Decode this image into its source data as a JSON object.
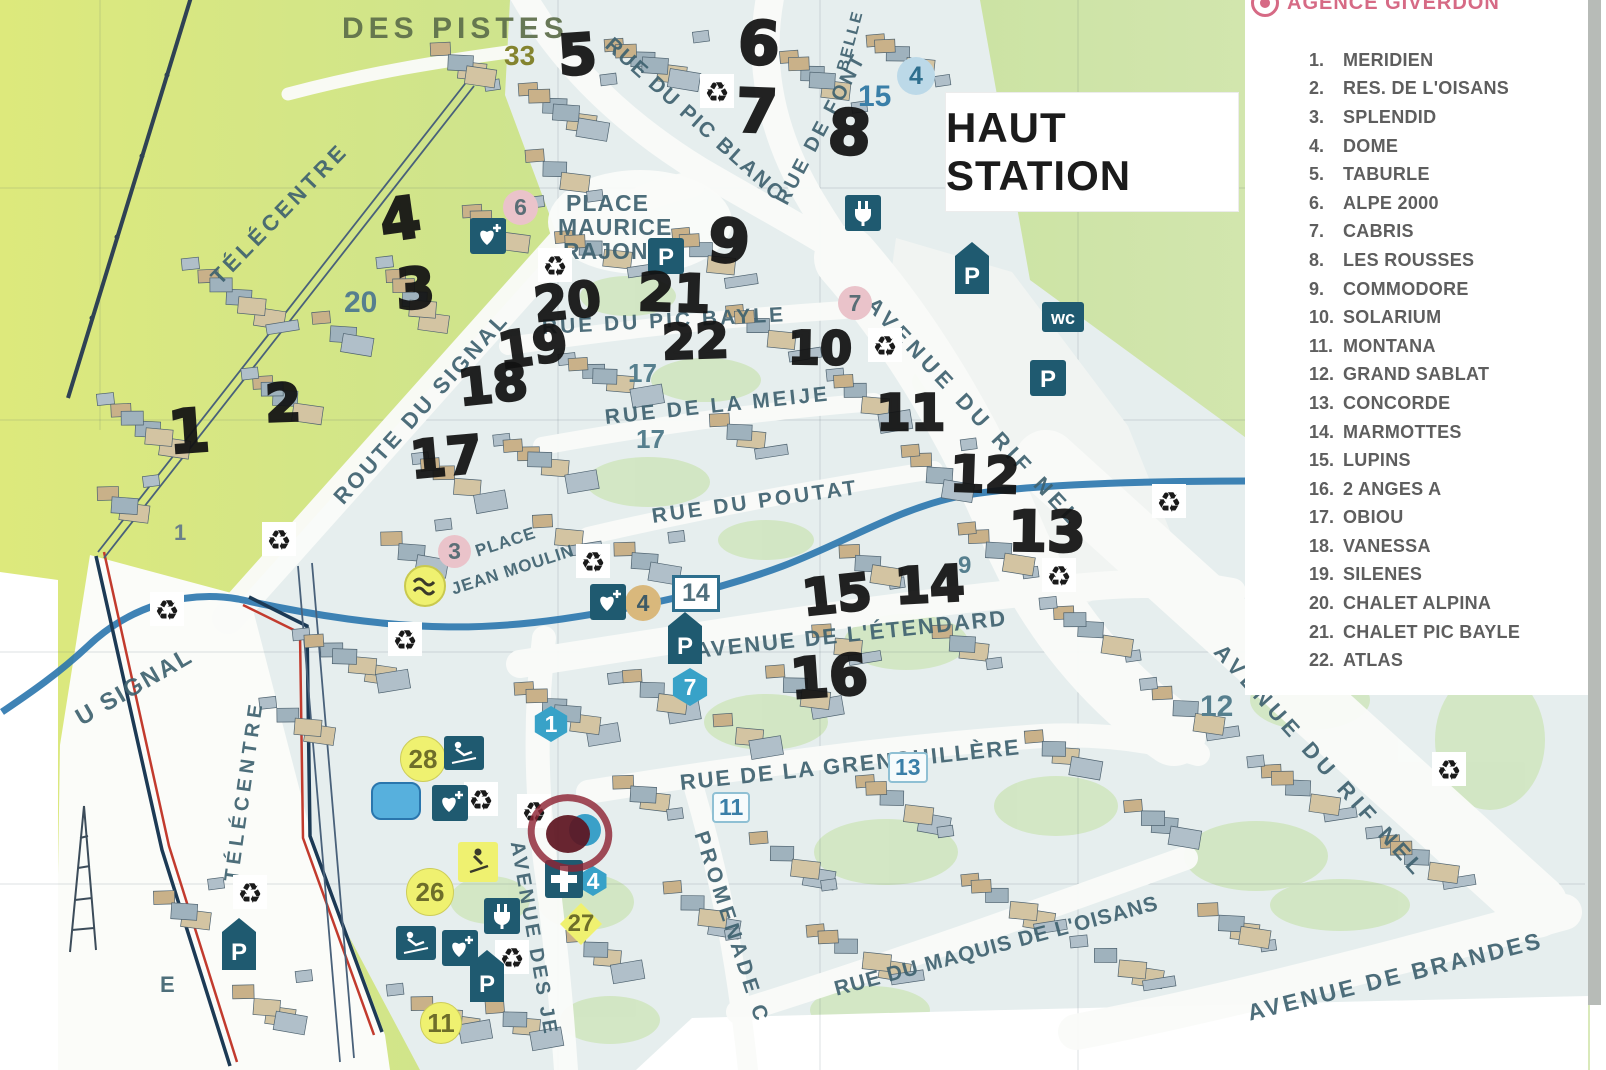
{
  "map": {
    "title": "HAUT STATION",
    "street_labels": [
      {
        "name": "DES PISTES",
        "x": 342,
        "y": 12,
        "rot": 0,
        "size": 30,
        "ls": 5,
        "cls": "olive"
      },
      {
        "name": "TÉLÉCENTRE",
        "x": 215,
        "y": 268,
        "rot": -46,
        "size": 22,
        "ls": 4
      },
      {
        "name": "TÉLÉCENTRE",
        "x": 232,
        "y": 870,
        "rot": -82,
        "size": 20,
        "ls": 5
      },
      {
        "name": "RUE DU PIC BLANC",
        "x": 608,
        "y": 30,
        "rot": 42,
        "size": 21,
        "ls": 2
      },
      {
        "name": "RUE DE FONT",
        "x": 782,
        "y": 192,
        "rot": -62,
        "size": 20,
        "ls": 3
      },
      {
        "name": "BELLE",
        "x": 843,
        "y": 62,
        "rot": -75,
        "size": 16,
        "ls": 2
      },
      {
        "name": "PLACE",
        "x": 566,
        "y": 190,
        "rot": 0,
        "size": 23,
        "ls": 1
      },
      {
        "name": "MAURICE",
        "x": 558,
        "y": 214,
        "rot": 0,
        "size": 23,
        "ls": 1
      },
      {
        "name": "RAJON",
        "x": 563,
        "y": 238,
        "rot": 0,
        "size": 23,
        "ls": 1
      },
      {
        "name": "RUE DU PIC BAYLE",
        "x": 542,
        "y": 316,
        "rot": -3,
        "size": 21,
        "ls": 3
      },
      {
        "name": "RUE DE LA MEIJE",
        "x": 605,
        "y": 406,
        "rot": -6,
        "size": 21,
        "ls": 3
      },
      {
        "name": "RUE DU POUTAT",
        "x": 652,
        "y": 505,
        "rot": -8,
        "size": 21,
        "ls": 3
      },
      {
        "name": "AVENUE DU RIF NEL",
        "x": 870,
        "y": 288,
        "rot": 47,
        "size": 22,
        "ls": 5
      },
      {
        "name": "ROUTE DU SIGNAL",
        "x": 338,
        "y": 488,
        "rot": -48,
        "size": 22,
        "ls": 3
      },
      {
        "name": "U SIGNAL",
        "x": 78,
        "y": 706,
        "rot": -30,
        "size": 24,
        "ls": 2
      },
      {
        "name": "PLACE",
        "x": 476,
        "y": 542,
        "rot": -18,
        "size": 17,
        "ls": 1
      },
      {
        "name": "JEAN MOULIN",
        "x": 452,
        "y": 580,
        "rot": -18,
        "size": 17,
        "ls": 1
      },
      {
        "name": "AVENUE DE L'ÉTENDARD",
        "x": 695,
        "y": 638,
        "rot": -6,
        "size": 22,
        "ls": 2
      },
      {
        "name": "RUE DE LA GRENOUILLÈRE",
        "x": 680,
        "y": 770,
        "rot": -6,
        "size": 22,
        "ls": 2
      },
      {
        "name": "PROMENADE C",
        "x": 700,
        "y": 820,
        "rot": 72,
        "size": 21,
        "ls": 4
      },
      {
        "name": "AVENUE DES JE",
        "x": 516,
        "y": 830,
        "rot": 80,
        "size": 20,
        "ls": 3
      },
      {
        "name": "RUE DU MAQUIS DE L'OISANS",
        "x": 835,
        "y": 978,
        "rot": -15,
        "size": 21,
        "ls": 1
      },
      {
        "name": "AVENUE DE BRANDES",
        "x": 1248,
        "y": 1000,
        "rot": -14,
        "size": 23,
        "ls": 3
      },
      {
        "name": "AVENUE DU RIF NEL",
        "x": 1218,
        "y": 635,
        "rot": 48,
        "size": 22,
        "ls": 5
      },
      {
        "name": "E",
        "x": 160,
        "y": 972,
        "rot": 0,
        "size": 22,
        "ls": 0
      }
    ],
    "handwritten_numbers": [
      {
        "label": "1",
        "x": 168,
        "y": 402,
        "size": 60,
        "rot": -4
      },
      {
        "label": "2",
        "x": 265,
        "y": 378,
        "size": 52,
        "rot": -2
      },
      {
        "label": "3",
        "x": 396,
        "y": 262,
        "size": 56,
        "rot": -3
      },
      {
        "label": "4",
        "x": 380,
        "y": 190,
        "size": 58,
        "rot": -8
      },
      {
        "label": "5",
        "x": 558,
        "y": 28,
        "size": 56,
        "rot": -4
      },
      {
        "label": "6",
        "x": 738,
        "y": 14,
        "size": 60,
        "rot": 3
      },
      {
        "label": "7",
        "x": 736,
        "y": 82,
        "size": 60,
        "rot": 2
      },
      {
        "label": "8",
        "x": 828,
        "y": 102,
        "size": 62,
        "rot": 4
      },
      {
        "label": "9",
        "x": 708,
        "y": 212,
        "size": 60,
        "rot": 5
      },
      {
        "label": "10",
        "x": 788,
        "y": 325,
        "size": 46,
        "rot": 1
      },
      {
        "label": "11",
        "x": 876,
        "y": 388,
        "size": 50,
        "rot": 0
      },
      {
        "label": "12",
        "x": 950,
        "y": 450,
        "size": 50,
        "rot": 2
      },
      {
        "label": "13",
        "x": 1008,
        "y": 505,
        "size": 56,
        "rot": 1
      },
      {
        "label": "14",
        "x": 895,
        "y": 560,
        "size": 50,
        "rot": -3
      },
      {
        "label": "15",
        "x": 802,
        "y": 570,
        "size": 50,
        "rot": -6
      },
      {
        "label": "16",
        "x": 790,
        "y": 650,
        "size": 56,
        "rot": -4
      },
      {
        "label": "17",
        "x": 410,
        "y": 432,
        "size": 52,
        "rot": -5
      },
      {
        "label": "18",
        "x": 458,
        "y": 360,
        "size": 50,
        "rot": -6
      },
      {
        "label": "19",
        "x": 498,
        "y": 322,
        "size": 50,
        "rot": -8
      },
      {
        "label": "20",
        "x": 534,
        "y": 278,
        "size": 48,
        "rot": -6
      },
      {
        "label": "21",
        "x": 638,
        "y": 268,
        "size": 52,
        "rot": 2
      },
      {
        "label": "22",
        "x": 662,
        "y": 318,
        "size": 48,
        "rot": -2
      }
    ],
    "printed_labels": [
      {
        "text": "33",
        "style": "olive",
        "x": 504,
        "y": 40,
        "size": 28
      },
      {
        "text": "20",
        "style": "slate",
        "x": 344,
        "y": 286,
        "size": 30
      },
      {
        "text": "15",
        "style": "blue",
        "x": 858,
        "y": 80,
        "size": 30
      },
      {
        "text": "4",
        "style": "circle-blue",
        "x": 897,
        "y": 57,
        "d": 38
      },
      {
        "text": "6",
        "style": "circle-pink",
        "x": 503,
        "y": 190,
        "d": 35
      },
      {
        "text": "7",
        "style": "circle-pink",
        "x": 838,
        "y": 286,
        "d": 34
      },
      {
        "text": "3",
        "style": "circle-pink",
        "x": 438,
        "y": 535,
        "d": 33
      },
      {
        "text": "17",
        "style": "slate",
        "x": 628,
        "y": 358,
        "size": 26
      },
      {
        "text": "17",
        "style": "slate",
        "x": 636,
        "y": 424,
        "size": 26
      },
      {
        "text": "9",
        "style": "slate",
        "x": 958,
        "y": 552,
        "size": 24
      },
      {
        "text": "14",
        "style": "frame",
        "x": 672,
        "y": 575,
        "size": 25
      },
      {
        "text": "4",
        "style": "circle-tan",
        "x": 625,
        "y": 585,
        "d": 36
      },
      {
        "text": "7",
        "style": "hex-blue",
        "x": 671,
        "y": 668,
        "d": 38
      },
      {
        "text": "1",
        "style": "hex-blue",
        "x": 533,
        "y": 706,
        "d": 36
      },
      {
        "text": "4",
        "style": "hex-blue",
        "x": 578,
        "y": 866,
        "d": 30
      },
      {
        "text": "12",
        "style": "slate",
        "x": 1200,
        "y": 690,
        "size": 30
      },
      {
        "text": "11",
        "style": "tag",
        "x": 712,
        "y": 792,
        "size": 23
      },
      {
        "text": "13",
        "style": "tag",
        "x": 888,
        "y": 752,
        "size": 23
      },
      {
        "text": "28",
        "style": "circle-yellow",
        "x": 400,
        "y": 736,
        "d": 44
      },
      {
        "text": "26",
        "style": "circle-yellow",
        "x": 406,
        "y": 868,
        "d": 46
      },
      {
        "text": "27",
        "style": "diamond-yellow",
        "x": 560,
        "y": 903,
        "d": 42
      },
      {
        "text": "11",
        "style": "circle-yellow",
        "x": 420,
        "y": 1002,
        "d": 40
      },
      {
        "text": "1",
        "style": "slate-sm",
        "x": 174,
        "y": 520,
        "size": 22
      }
    ],
    "icons": [
      {
        "type": "recycle",
        "x": 538,
        "y": 248
      },
      {
        "type": "recycle",
        "x": 700,
        "y": 74
      },
      {
        "type": "recycle",
        "x": 868,
        "y": 328
      },
      {
        "type": "recycle",
        "x": 1152,
        "y": 484
      },
      {
        "type": "recycle",
        "x": 1042,
        "y": 558
      },
      {
        "type": "recycle",
        "x": 262,
        "y": 522
      },
      {
        "type": "recycle",
        "x": 150,
        "y": 592
      },
      {
        "type": "recycle",
        "x": 388,
        "y": 622
      },
      {
        "type": "recycle",
        "x": 576,
        "y": 544
      },
      {
        "type": "recycle",
        "x": 464,
        "y": 782
      },
      {
        "type": "recycle",
        "x": 517,
        "y": 794
      },
      {
        "type": "recycle",
        "x": 233,
        "y": 875
      },
      {
        "type": "recycle",
        "x": 495,
        "y": 940
      },
      {
        "type": "recycle",
        "x": 1432,
        "y": 752
      },
      {
        "type": "parking",
        "x": 648,
        "y": 238
      },
      {
        "type": "parking",
        "x": 1030,
        "y": 360
      },
      {
        "type": "parking-pillar",
        "x": 955,
        "y": 242
      },
      {
        "type": "parking-pillar",
        "x": 668,
        "y": 612
      },
      {
        "type": "parking-pillar",
        "x": 222,
        "y": 918
      },
      {
        "type": "parking-pillar",
        "x": 470,
        "y": 950
      },
      {
        "type": "wc",
        "x": 1042,
        "y": 302
      },
      {
        "type": "plug",
        "x": 845,
        "y": 195
      },
      {
        "type": "plug",
        "x": 484,
        "y": 898
      },
      {
        "type": "heart",
        "x": 470,
        "y": 218
      },
      {
        "type": "heart",
        "x": 590,
        "y": 584
      },
      {
        "type": "heart",
        "x": 432,
        "y": 785
      },
      {
        "type": "heart",
        "x": 442,
        "y": 930
      },
      {
        "type": "skier",
        "x": 444,
        "y": 736
      },
      {
        "type": "skier",
        "x": 396,
        "y": 926
      },
      {
        "type": "jump",
        "x": 458,
        "y": 842
      },
      {
        "type": "cross",
        "x": 545,
        "y": 860
      },
      {
        "type": "wave",
        "x": 404,
        "y": 565
      }
    ],
    "target_marker": {
      "x": 570,
      "y": 833
    }
  },
  "legend": {
    "agency": "AGENCE GIVERDON",
    "items": [
      {
        "num": "1.",
        "name": "MERIDIEN"
      },
      {
        "num": "2.",
        "name": "RES. DE L'OISANS"
      },
      {
        "num": "3.",
        "name": "SPLENDID"
      },
      {
        "num": "4.",
        "name": "DOME"
      },
      {
        "num": "5.",
        "name": "TABURLE"
      },
      {
        "num": "6.",
        "name": "ALPE 2000"
      },
      {
        "num": "7.",
        "name": "CABRIS"
      },
      {
        "num": "8.",
        "name": "LES ROUSSES"
      },
      {
        "num": "9.",
        "name": "COMMODORE"
      },
      {
        "num": "10.",
        "name": "SOLARIUM"
      },
      {
        "num": "11.",
        "name": "MONTANA"
      },
      {
        "num": "12.",
        "name": "GRAND SABLAT"
      },
      {
        "num": "13.",
        "name": "CONCORDE"
      },
      {
        "num": "14.",
        "name": "MARMOTTES"
      },
      {
        "num": "15.",
        "name": "LUPINS"
      },
      {
        "num": "16.",
        "name": "2 ANGES A"
      },
      {
        "num": "17.",
        "name": "OBIOU"
      },
      {
        "num": "18.",
        "name": "VANESSA"
      },
      {
        "num": "19.",
        "name": "SILENES"
      },
      {
        "num": "20.",
        "name": "CHALET ALPINA"
      },
      {
        "num": "21.",
        "name": "CHALET PIC BAYLE"
      },
      {
        "num": "22.",
        "name": "ATLAS"
      }
    ]
  },
  "colors": {
    "marker_black": "#121212",
    "sign_teal": "#1f5a70",
    "agency_pink": "#d66a85",
    "stream_blue": "#2a76ad",
    "legend_gray": "#5e5e5e",
    "terrain_green": "#d5e58b",
    "piste_red": "#c23b2e",
    "piste_navy": "#1c3a55",
    "highlight_yellow": "#eff170"
  }
}
